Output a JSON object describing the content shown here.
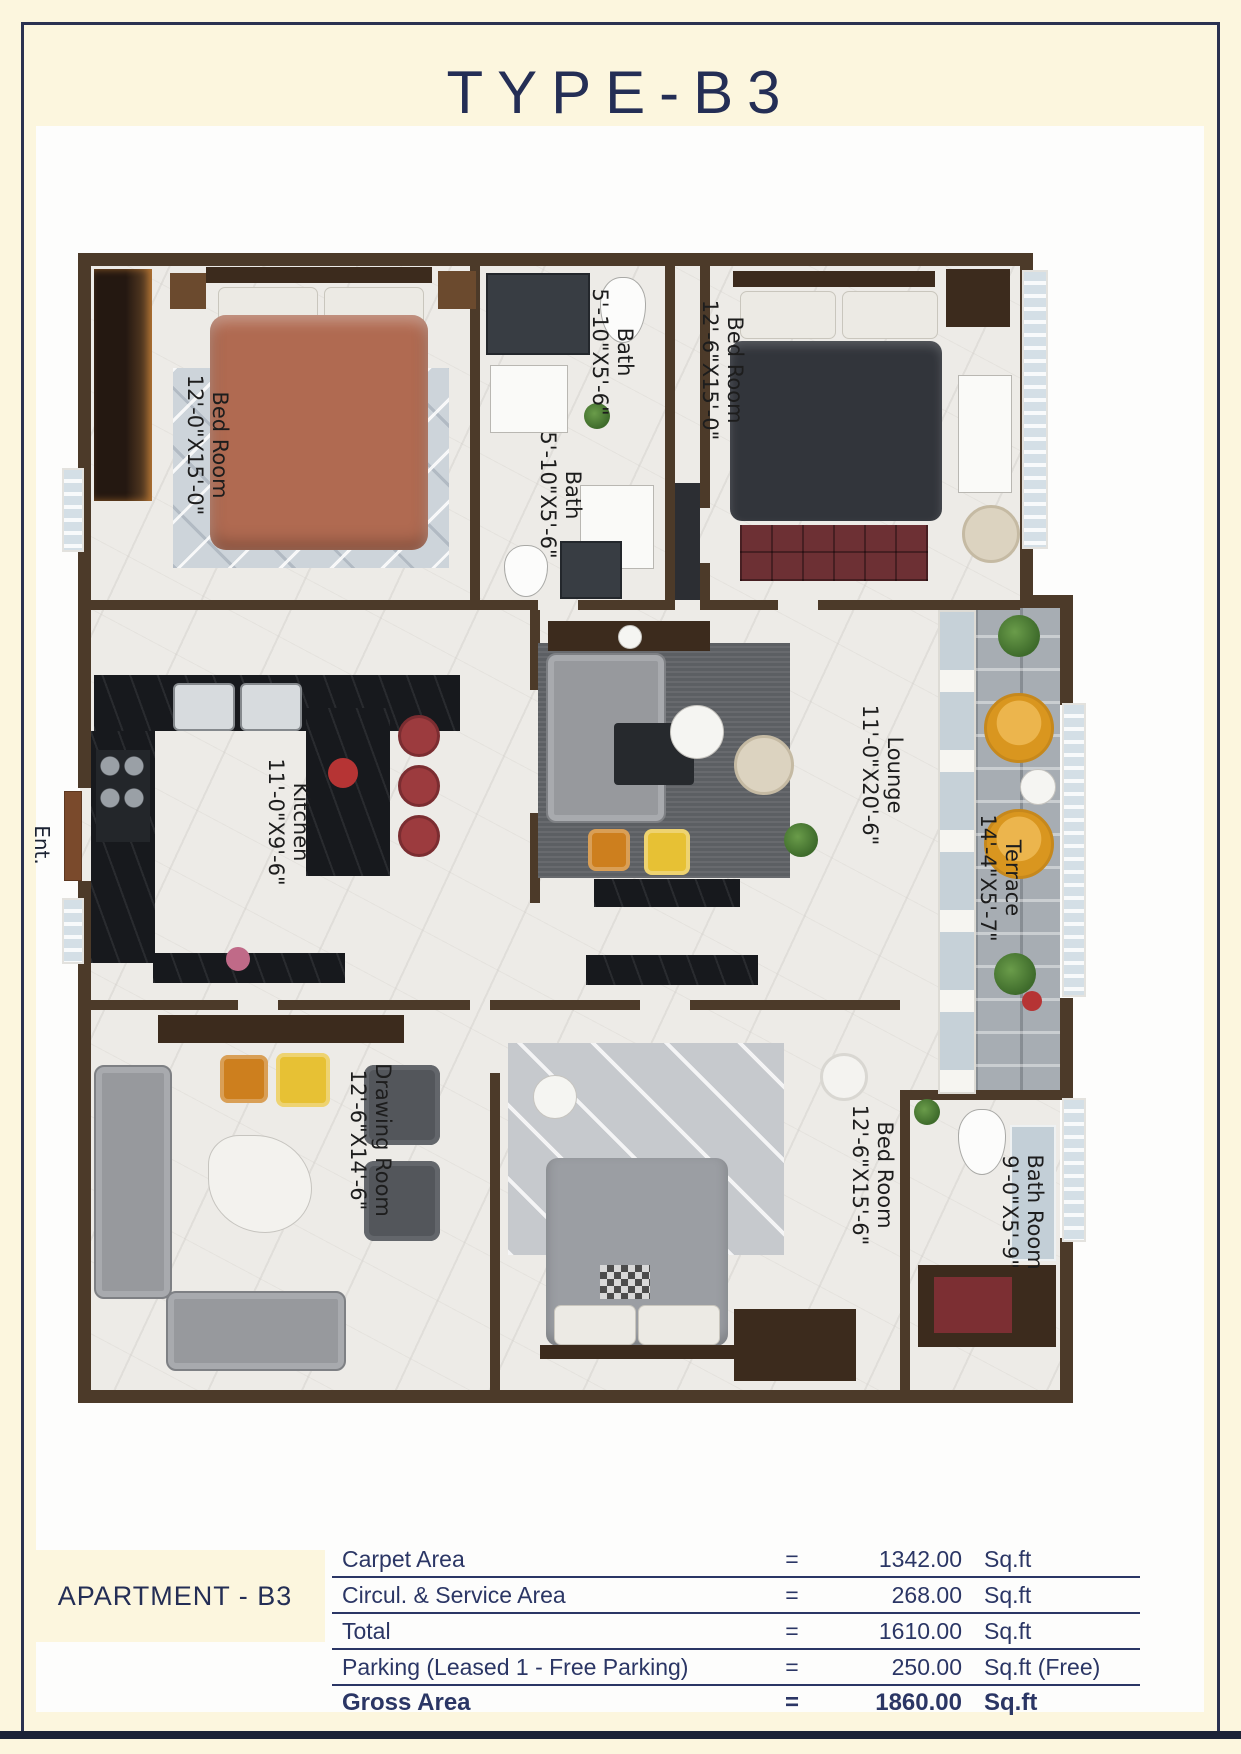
{
  "page": {
    "title": "TYPE-B3",
    "apartment_label": "APARTMENT - B3",
    "entrance_label": "Ent."
  },
  "rooms": [
    {
      "name": "Bed Room",
      "dims": "12'-0\"X15'-0\""
    },
    {
      "name": "Bath",
      "dims": "5'-10\"X5'-6\""
    },
    {
      "name": "Bath",
      "dims": "5'-10\"X5'-6\""
    },
    {
      "name": "Bed Room",
      "dims": "12'-6\"X15'-0\""
    },
    {
      "name": "Kitchen",
      "dims": "11'-0\"X9'-6\""
    },
    {
      "name": "Lounge",
      "dims": "11'-0\"X20'-6\""
    },
    {
      "name": "Terrace",
      "dims": "14'-4\"X5'-7\""
    },
    {
      "name": "Drawing Room",
      "dims": "12'-6\"X14'-6\""
    },
    {
      "name": "Bed Room",
      "dims": "12'-6\"X15'-6\""
    },
    {
      "name": "Bath Room",
      "dims": "9'-0\"X5'-9\""
    }
  ],
  "area_table": {
    "rows": [
      {
        "label": "Carpet Area",
        "eq": "=",
        "value": "1342.00",
        "unit": "Sq.ft"
      },
      {
        "label": "Circul. & Service Area",
        "eq": "=",
        "value": "268.00",
        "unit": "Sq.ft"
      },
      {
        "label": "Total",
        "eq": "=",
        "value": "1610.00",
        "unit": "Sq.ft"
      },
      {
        "label": "Parking (Leased 1 - Free Parking)",
        "eq": "=",
        "value": "250.00",
        "unit": "Sq.ft (Free)"
      },
      {
        "label": "Gross Area",
        "eq": "=",
        "value": "1860.00",
        "unit": "Sq.ft"
      }
    ]
  },
  "colors": {
    "page_background": "#fcf6de",
    "navy": "#242e55",
    "wall_brown": "#4c3a29",
    "accent_yellow": "#e7c134",
    "accent_orange": "#cd7f1e",
    "accent_maroon": "#6d3034",
    "accent_terracotta": "#b06a51"
  }
}
